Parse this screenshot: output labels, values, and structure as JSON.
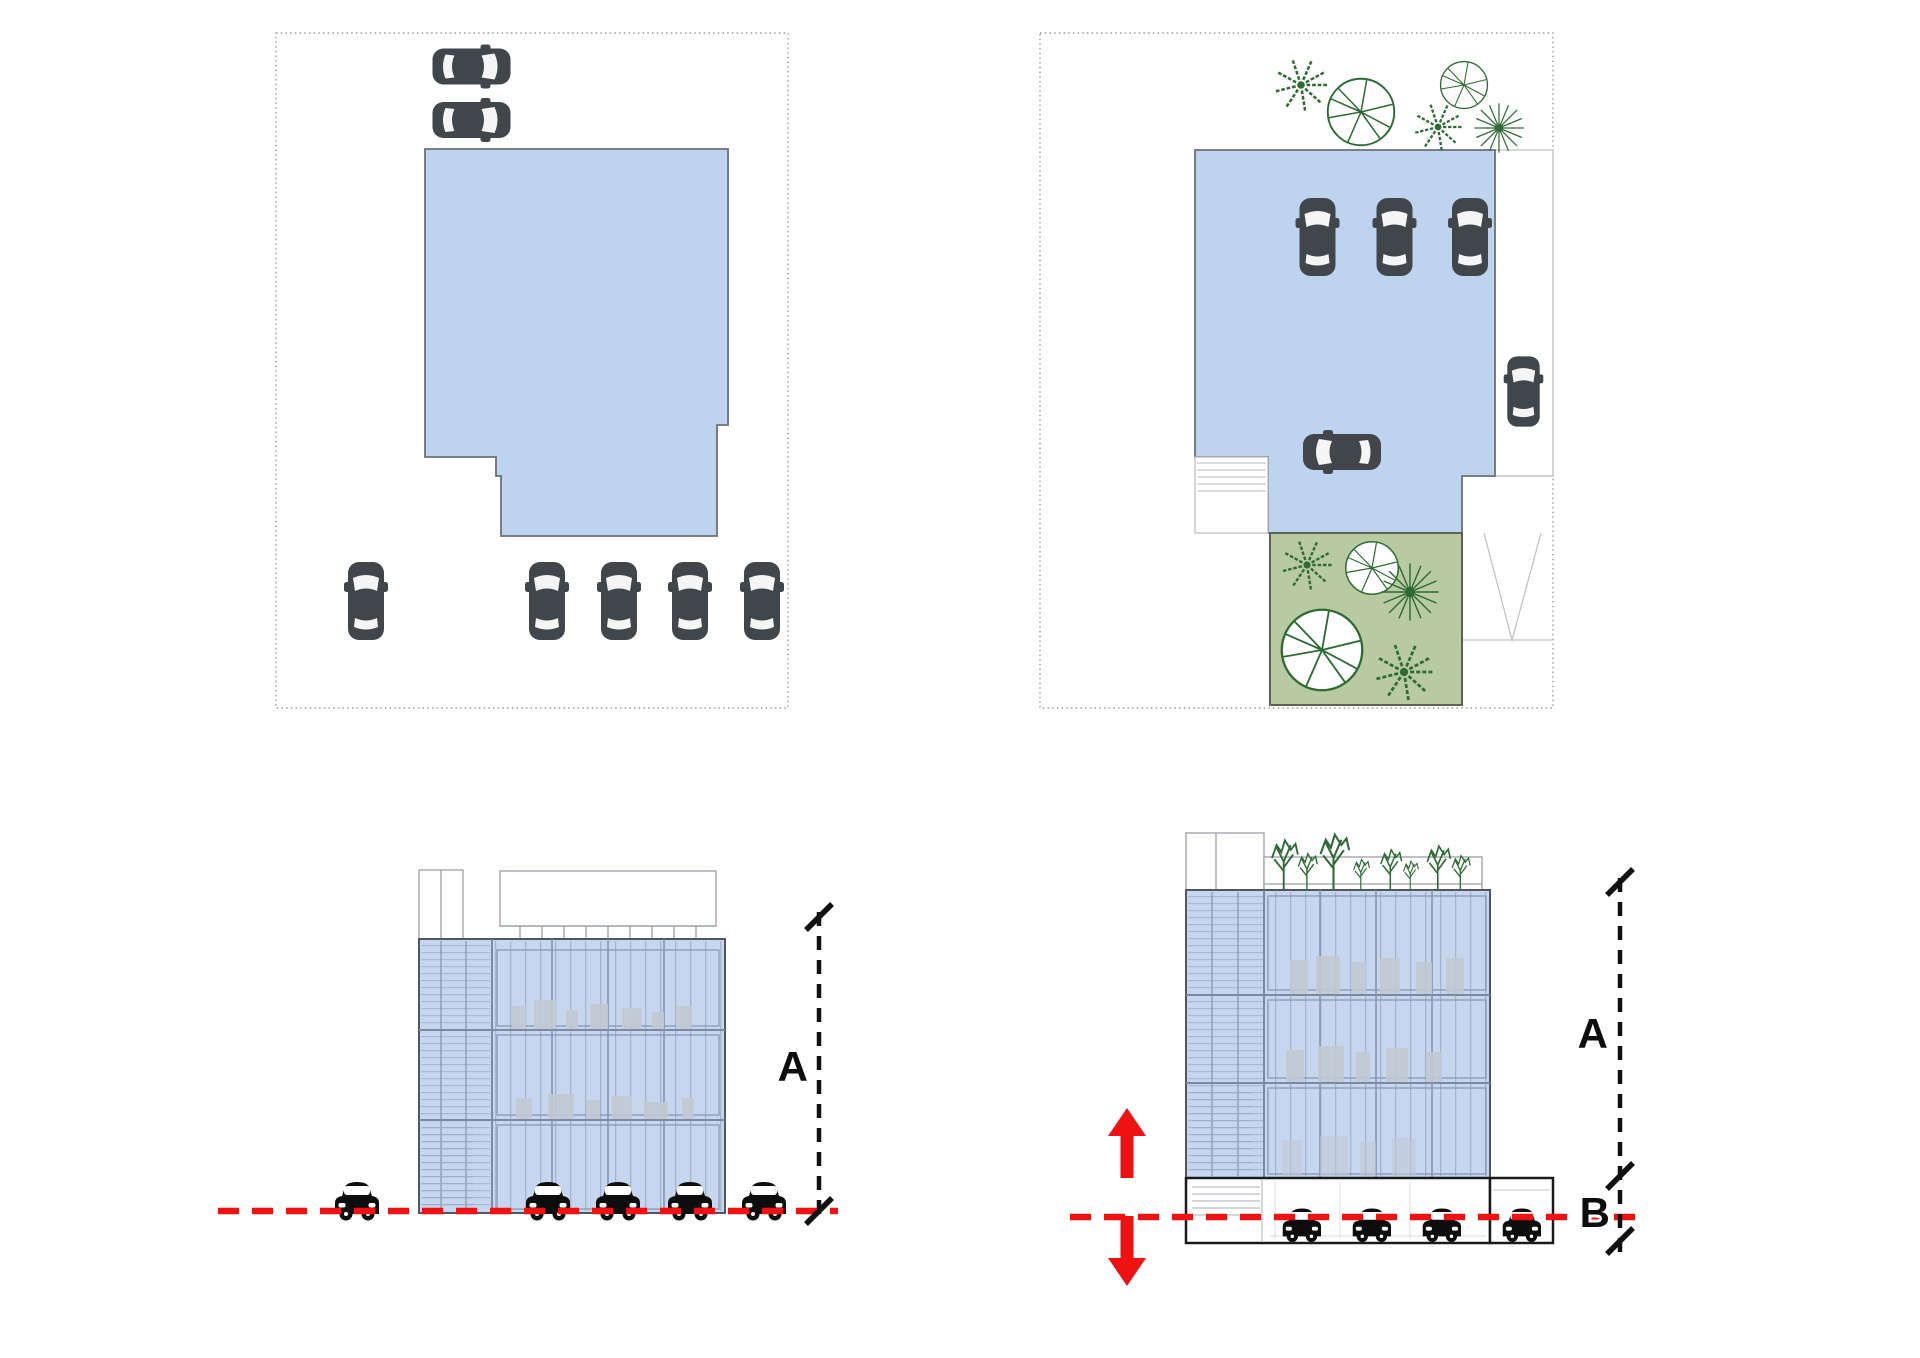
{
  "diagram": {
    "kind": "architectural site-plan and elevation massing diagram",
    "panel_count": 4,
    "labels": {
      "dim_a_left": "A",
      "dim_a_right": "A",
      "dim_b_right": "B"
    },
    "panels": {
      "site_plan_existing": {
        "boundary": "dotted",
        "building_footprint_color": "#bdd3ee",
        "street_cars_top": 2,
        "street_cars_bottom": 5
      },
      "site_plan_proposed": {
        "boundary": "dotted",
        "building_footprint_color": "#bdd3ee",
        "garden_color": "#b8caa0",
        "garden_trees": 5,
        "perimeter_trees": 5,
        "cars_on_deck": 4,
        "cars_on_street": 1
      },
      "elevation_existing": {
        "floors": 3,
        "street_cars": 4,
        "isolated_car": 1,
        "ground_line": "red-dashed",
        "height_dimension": "A"
      },
      "elevation_proposed": {
        "floors": 3,
        "roof_trees": 8,
        "parking_level_cars": 4,
        "ground_line": "red-dashed",
        "height_dimensions": [
          "A",
          "B"
        ],
        "shift_arrows": [
          "up",
          "down"
        ]
      }
    },
    "colors": {
      "footprint_fill": "#bdd3ee",
      "facade_fill": "#c6d6ee",
      "facade_line": "#8494ac",
      "garden_fill": "#b8caa0",
      "tree_stroke": "#2e6b34",
      "car_plan_gray": "#41464b",
      "car_elevation_black": "#0d0d0d",
      "ground_red": "#ee1212",
      "dimension_black": "#111111",
      "boundary_gray": "#9a9a9a"
    }
  }
}
